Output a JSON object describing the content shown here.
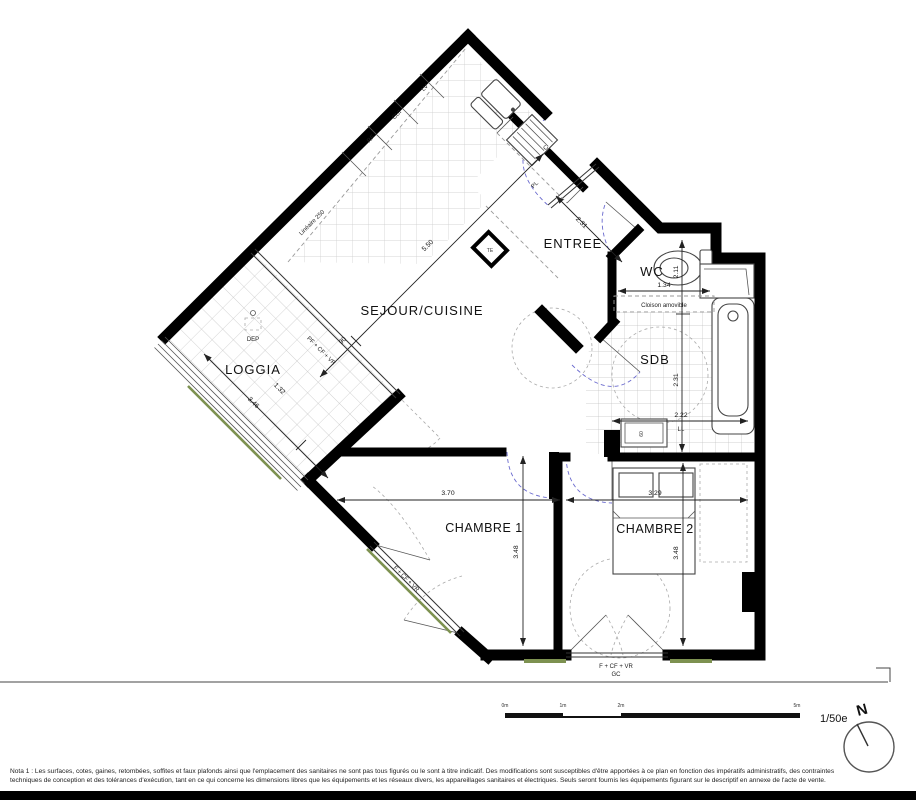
{
  "plan": {
    "rooms": {
      "sejour": "SEJOUR/CUISINE",
      "entree": "ENTREE",
      "wc": "WC",
      "sdb": "SDB",
      "loggia": "LOGGIA",
      "chambre1": "CHAMBRE 1",
      "chambre2": "CHAMBRE 2"
    },
    "fixtures": {
      "rf": "RF",
      "cui": "CUI",
      "lv": "LV",
      "c": "C",
      "te": "TE",
      "pl": "PL",
      "dep": "DEP",
      "ll": "LL"
    },
    "annotations": {
      "lineaire": "Linéaire 250",
      "cloison": "Cloison amovible",
      "window_ch1": "F + CF + VR",
      "window_bottom": "F + CF + VR",
      "gc": "GC",
      "loggia_door": "PF + CF + VR"
    },
    "dims": {
      "ch1_width": "3.70",
      "ch1_depth": "3.48",
      "ch2_width": "3.29",
      "ch2_depth": "3.48",
      "wc_width": "1.34",
      "wc_depth": "2.11",
      "sdb_depth": "2.31",
      "sdb_width": "2.22",
      "entree_depth": "2.31",
      "loggia_length": "3.46",
      "loggia_width": "1.32",
      "sejour_diag": "5.50",
      "bay_width": "90",
      "ll_width": "60"
    },
    "footer": {
      "scale_label": "1/50e",
      "north": "N",
      "tick0": "0m",
      "tick1": "1m",
      "tick2": "2m",
      "tick3": "5m",
      "nota_line1": "Nota 1 : Les surfaces, cotes, gaines, retombées, soffites et faux plafonds ainsi que l'emplacement des sanitaires ne sont pas tous figurés ou le sont à titre indicatif. Des modifications sont susceptibles d'être apportées à ce plan en fonction des impératifs administratifs, des contraintes",
      "nota_line2": "techniques de conception et des tolérances d'exécution, tant en ce qui concerne les dimensions libres que les équipements et les réseaux divers, les appareillages sanitaires et électriques. Seuls seront fournis les équipements figurant sur le descriptif en annexe de l'acte de vente."
    }
  }
}
